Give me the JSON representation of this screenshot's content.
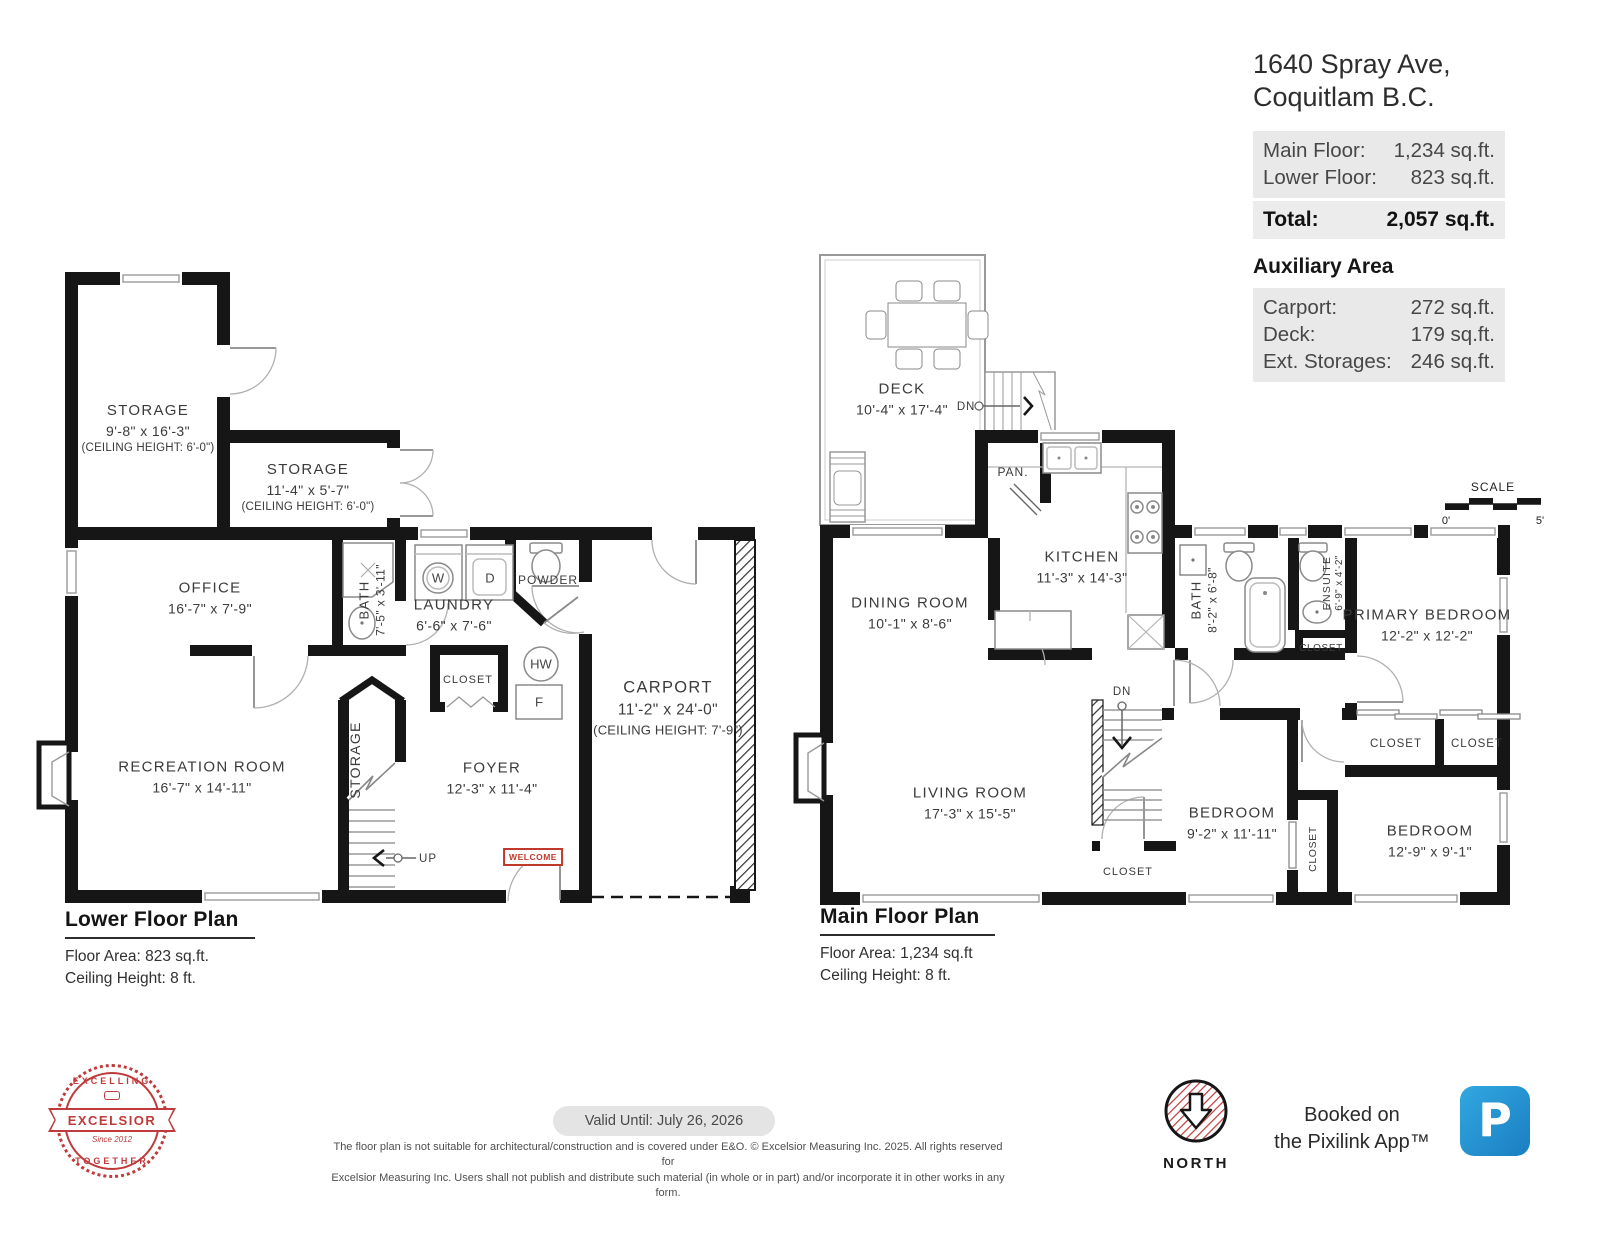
{
  "header": {
    "address1": "1640 Spray Ave,",
    "address2": "Coquitlam B.C.",
    "rows": [
      {
        "label": "Main Floor:",
        "value": "1,234 sq.ft."
      },
      {
        "label": "Lower Floor:",
        "value": "823 sq.ft."
      }
    ],
    "total": {
      "label": "Total:",
      "value": "2,057 sq.ft."
    },
    "aux_title": "Auxiliary Area",
    "aux": [
      {
        "label": "Carport:",
        "value": "272 sq.ft."
      },
      {
        "label": "Deck:",
        "value": "179 sq.ft."
      },
      {
        "label": "Ext. Storages:",
        "value": "246 sq.ft."
      }
    ]
  },
  "lower": {
    "title": "Lower Floor Plan",
    "area": "Floor Area: 823 sq.ft.",
    "ceiling": "Ceiling Height: 8 ft.",
    "rooms": {
      "storage_a": {
        "name": "STORAGE",
        "dims": "9'-8\" x 16'-3\"",
        "ceil": "(CEILING HEIGHT: 6'-0\")"
      },
      "storage_b": {
        "name": "STORAGE",
        "dims": "11'-4\" x 5'-7\"",
        "ceil": "(CEILING HEIGHT: 6'-0\")"
      },
      "office": {
        "name": "OFFICE",
        "dims": "16'-7\" x 7'-9\""
      },
      "bath": {
        "name": "BATH",
        "dims": "7'-5\" x 3'-11\""
      },
      "laundry": {
        "name": "LAUNDRY",
        "dims": "6'-6\" x 7'-6\""
      },
      "powder": {
        "name": "POWDER"
      },
      "closet": {
        "name": "CLOSET"
      },
      "storage_c": {
        "name": "STORAGE"
      },
      "rec": {
        "name": "RECREATION ROOM",
        "dims": "16'-7\" x 14'-11\""
      },
      "foyer": {
        "name": "FOYER",
        "dims": "12'-3\" x 11'-4\""
      },
      "carport": {
        "name": "CARPORT",
        "dims": "11'-2\" x 24'-0\"",
        "ceil": "(CEILING HEIGHT: 7'-9\")"
      }
    },
    "marks": {
      "washer": "W",
      "dryer": "D",
      "hot_water": "HW",
      "furnace": "F",
      "up": "UP",
      "welcome": "WELCOME"
    }
  },
  "main": {
    "title": "Main Floor Plan",
    "area": "Floor Area: 1,234 sq.ft",
    "ceiling": "Ceiling Height: 8 ft.",
    "rooms": {
      "deck": {
        "name": "DECK",
        "dims": "10'-4\" x 17'-4\""
      },
      "kitchen": {
        "name": "KITCHEN",
        "dims": "11'-3\" x 14'-3\""
      },
      "dining": {
        "name": "DINING ROOM",
        "dims": "10'-1\" x 8'-6\""
      },
      "living": {
        "name": "LIVING ROOM",
        "dims": "17'-3\" x 15'-5\""
      },
      "bath": {
        "name": "BATH",
        "dims": "8'-2\" x 6'-8\""
      },
      "ensuite": {
        "name": "ENSUITE",
        "dims": "6'-9\" x 4'-2\""
      },
      "primary": {
        "name": "PRIMARY BEDROOM",
        "dims": "12'-2\" x 12'-2\""
      },
      "bedroom_a": {
        "name": "BEDROOM",
        "dims": "9'-2\" x 11'-11\""
      },
      "bedroom_b": {
        "name": "BEDROOM",
        "dims": "12'-9\" x 9'-1\""
      },
      "pantry": {
        "name": "PAN."
      },
      "closet": {
        "name": "CLOSET"
      }
    },
    "marks": {
      "down": "DN"
    },
    "scale": {
      "label": "SCALE",
      "start": "0'",
      "end": "5'"
    }
  },
  "footer": {
    "valid": "Valid Until: July 26, 2026",
    "disc1": "The floor plan is not suitable for architectural/construction and is covered under E&O. © Excelsior Measuring Inc. 2025. All rights reserved for",
    "disc2": "Excelsior Measuring Inc. Users shall not publish and distribute such material (in whole or in part) and/or incorporate it in other works in any form.",
    "north": "NORTH",
    "booked1": "Booked on",
    "booked2": "the Pixilink App™",
    "logo": {
      "top": "EXCELLING",
      "middle": "EXCELSIOR",
      "bottom": "TOGETHER",
      "since": "Since 2012"
    },
    "pixilink": "P"
  },
  "colors": {
    "wall": "#161616",
    "accent_red": "#bf3a3a",
    "pixilink_blue": "#1f86c7",
    "panel_gray": "#e9e9e9"
  }
}
